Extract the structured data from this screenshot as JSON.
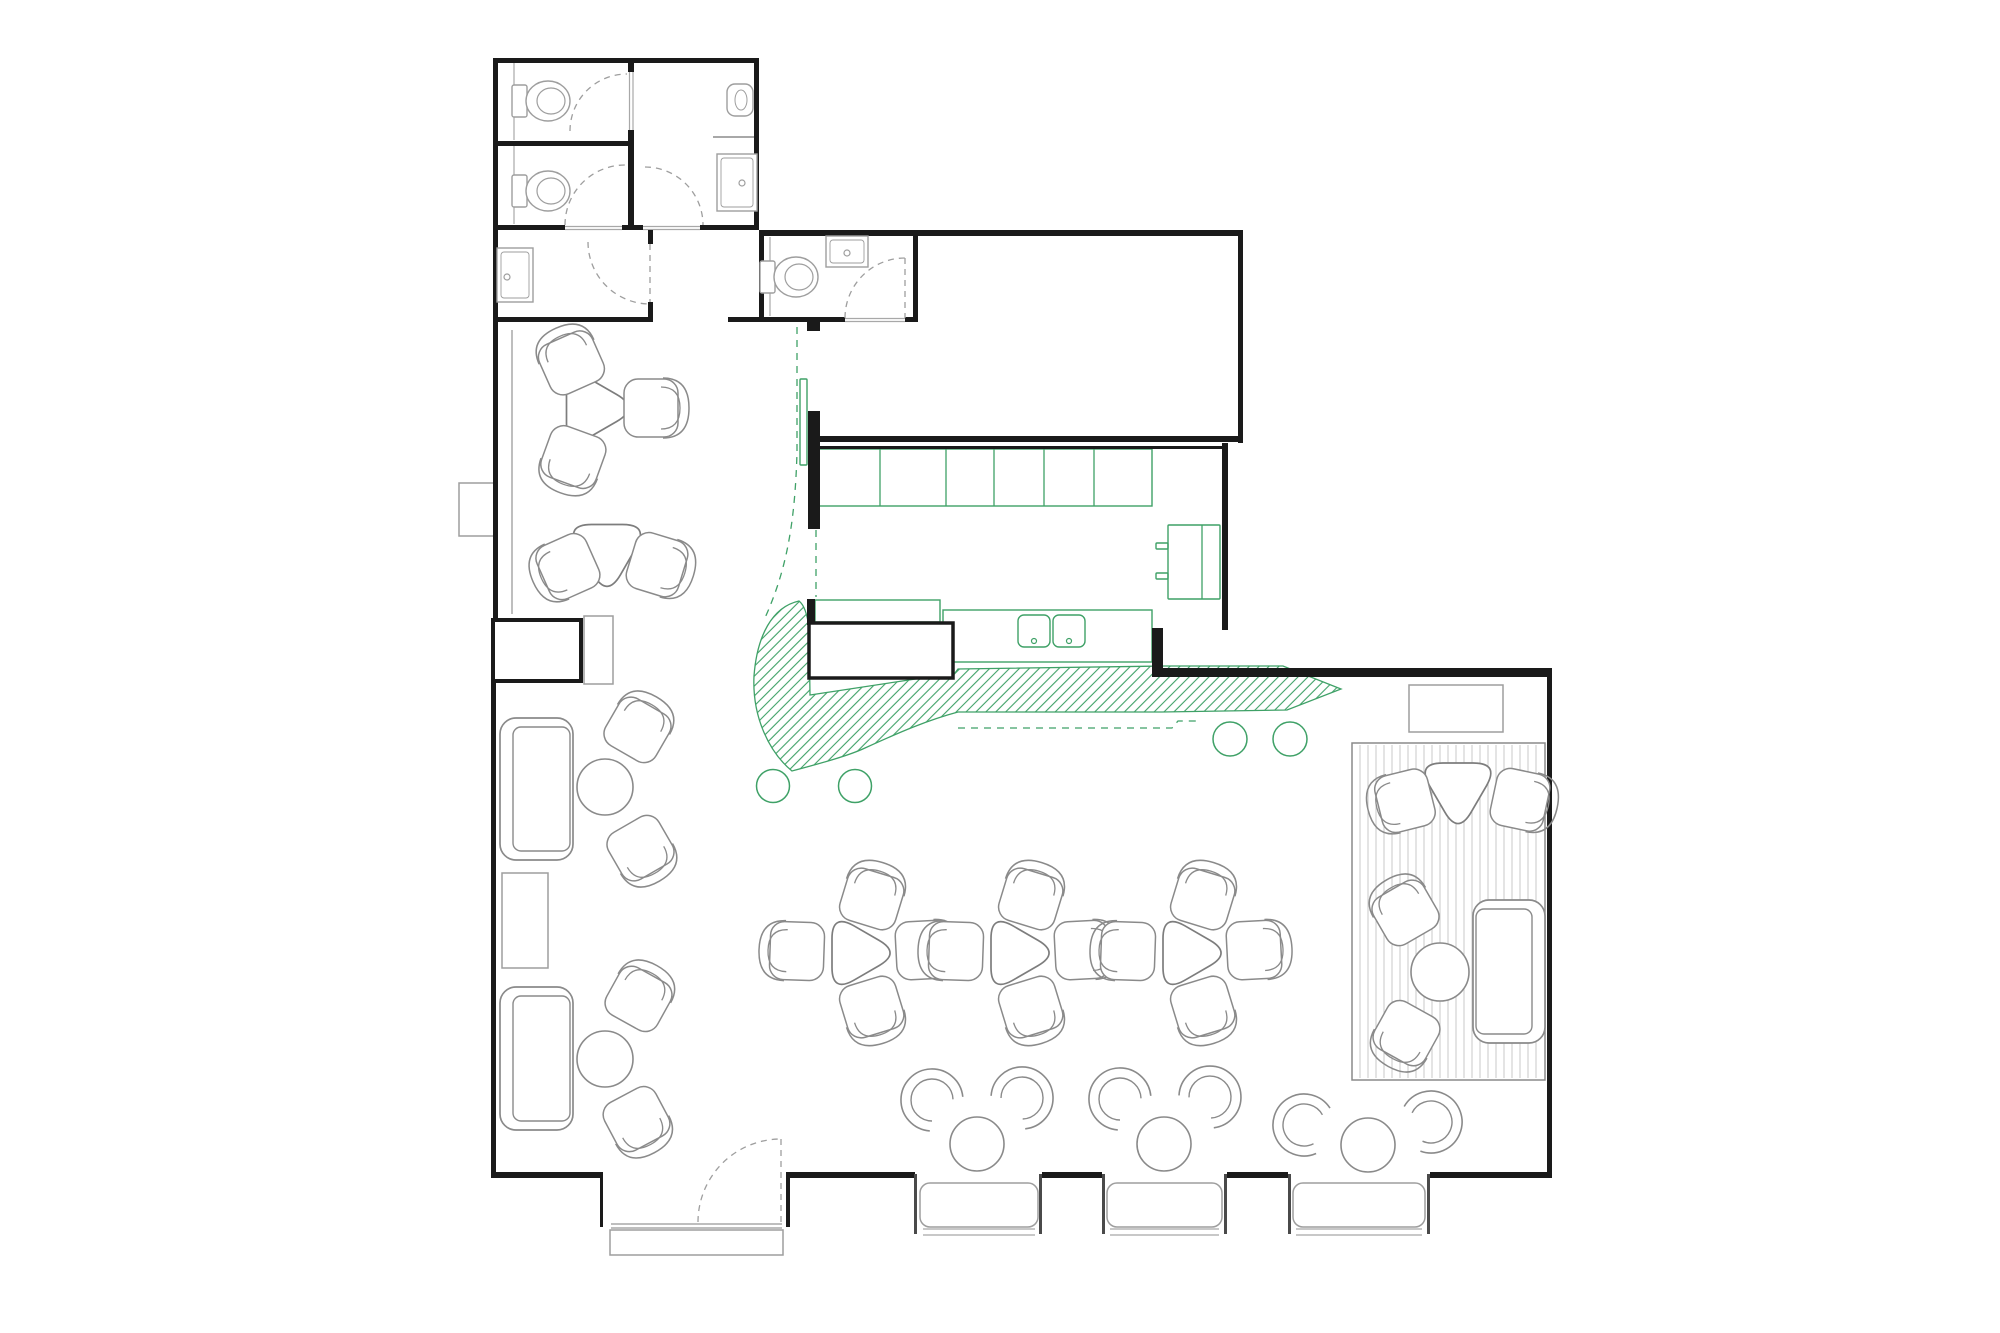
{
  "meta": {
    "title": "Restaurant floor plan with bar, kitchen, WC block, lounge and window seating"
  },
  "palette": {
    "bg": "#ffffff",
    "wall": "#1a1a1a",
    "jamb": "#4a4a4a",
    "furniture": "#8a8a8a",
    "fixture": "#9e9e9e",
    "grey_line": "#a8a8a8",
    "rug_stripe": "#c9c9c9",
    "dash_grey": "#9e9e9e",
    "green": "#3fa167"
  },
  "plan": {
    "walls": [
      [
        493,
        58,
        266,
        5
      ],
      [
        493,
        58,
        5,
        264
      ],
      [
        754,
        58,
        5,
        172
      ],
      [
        628,
        58,
        6,
        14
      ],
      [
        628,
        130,
        6,
        100
      ],
      [
        493,
        141,
        141,
        5
      ],
      [
        493,
        225,
        72,
        5
      ],
      [
        622,
        225,
        21,
        5
      ],
      [
        700,
        225,
        59,
        5
      ],
      [
        493,
        317,
        160,
        5
      ],
      [
        648,
        230,
        5,
        14
      ],
      [
        648,
        302,
        5,
        20
      ],
      [
        728,
        317,
        117,
        5
      ],
      [
        905,
        317,
        13,
        5
      ],
      [
        807,
        322,
        13,
        9
      ],
      [
        759,
        230,
        159,
        6
      ],
      [
        759,
        230,
        5,
        92
      ],
      [
        913,
        230,
        5,
        92
      ],
      [
        918,
        230,
        325,
        6
      ],
      [
        1238,
        230,
        5,
        213
      ],
      [
        812,
        436,
        431,
        6
      ],
      [
        812,
        446,
        416,
        3
      ],
      [
        808,
        411,
        12,
        118
      ],
      [
        1222,
        443,
        6,
        187
      ],
      [
        1152,
        628,
        11,
        49
      ],
      [
        1152,
        668,
        400,
        9
      ],
      [
        1547,
        668,
        5,
        510
      ],
      [
        493,
        322,
        5,
        300
      ],
      [
        491,
        681,
        5,
        497
      ],
      [
        493,
        1172,
        107,
        6
      ],
      [
        790,
        1172,
        125,
        6
      ],
      [
        1042,
        1172,
        60,
        6
      ],
      [
        1227,
        1172,
        61,
        6
      ],
      [
        1430,
        1172,
        122,
        6
      ],
      [
        600,
        1172,
        3,
        55
      ],
      [
        786,
        1172,
        4,
        55
      ],
      [
        807,
        599,
        8,
        26
      ]
    ],
    "jambs": [
      [
        914,
        1174,
        3,
        60
      ],
      [
        1039,
        1174,
        3,
        60
      ],
      [
        1102,
        1174,
        3,
        60
      ],
      [
        1224,
        1174,
        3,
        60
      ],
      [
        1288,
        1174,
        3,
        60
      ],
      [
        1427,
        1174,
        3,
        60
      ]
    ],
    "piers": [
      {
        "x": 493,
        "y": 620,
        "w": 88,
        "h": 61,
        "sw": 4,
        "name": "wall-pier"
      },
      {
        "x": 809,
        "y": 623,
        "w": 144,
        "h": 55,
        "sw": 3.5,
        "name": "bar-counter-block"
      }
    ],
    "grey_rects": [
      {
        "x": 584,
        "y": 616,
        "w": 29,
        "h": 68,
        "name": "service-console"
      },
      {
        "x": 502,
        "y": 873,
        "w": 46,
        "h": 95,
        "name": "low-table"
      },
      {
        "x": 1409,
        "y": 685,
        "w": 94,
        "h": 47,
        "name": "sideboard"
      },
      {
        "x": 459,
        "y": 483,
        "w": 38,
        "h": 53,
        "name": "wall-pier-west"
      },
      {
        "x": 610,
        "y": 1230,
        "w": 173,
        "h": 25,
        "name": "entry-mat"
      }
    ],
    "grey_lines": [
      [
        512,
        330,
        512,
        614,
        1.5
      ],
      [
        713,
        137,
        754,
        137,
        2
      ],
      [
        565,
        226.5,
        622,
        226.5,
        1.2
      ],
      [
        565,
        229.5,
        622,
        229.5,
        1.2
      ],
      [
        643,
        226.5,
        700,
        226.5,
        1.2
      ],
      [
        643,
        229.5,
        700,
        229.5,
        1.2
      ],
      [
        629.5,
        70,
        629.5,
        132,
        1.2
      ],
      [
        633,
        70,
        633,
        132,
        1.2
      ],
      [
        845,
        318.5,
        905,
        318.5,
        1.2
      ],
      [
        845,
        321.5,
        905,
        321.5,
        1.2
      ],
      [
        611,
        1224,
        782,
        1224,
        1.5
      ],
      [
        611,
        1228,
        782,
        1228,
        1.5
      ],
      [
        514,
        63,
        514,
        140,
        1.2
      ],
      [
        514,
        146,
        514,
        224,
        1.2
      ],
      [
        770,
        237,
        770,
        316,
        1.2
      ],
      [
        923,
        1229,
        1035,
        1229,
        1.2
      ],
      [
        923,
        1235,
        1035,
        1235,
        1.2
      ],
      [
        1110,
        1229,
        1219,
        1229,
        1.2
      ],
      [
        1110,
        1235,
        1219,
        1235,
        1.2
      ],
      [
        1296,
        1229,
        1422,
        1229,
        1.2
      ],
      [
        1296,
        1235,
        1422,
        1235,
        1.2
      ]
    ],
    "door_arcs": [
      "M570,131 A57,57 0 0 1 627,74",
      "M565,225 A60,60 0 0 1 625,165",
      "M645,167 A58,58 0 0 1 703,225",
      "M588,242 A62,62 0 0 0 650,304",
      "M845,318 A60,60 0 0 1 905,258",
      "M698,1222 A83,83 0 0 1 781,1139"
    ],
    "door_leaves": [
      [
        905,
        258,
        905,
        318
      ],
      [
        781,
        1139,
        781,
        1222
      ],
      [
        650,
        244,
        650,
        302
      ]
    ],
    "toilets": [
      {
        "cx": 545,
        "cy": 101
      },
      {
        "cx": 545,
        "cy": 191
      },
      {
        "cx": 793,
        "cy": 277
      }
    ],
    "sinks": [
      {
        "x": 717,
        "y": 154,
        "w": 40,
        "h": 57,
        "dx": 742,
        "dy": 183
      },
      {
        "x": 497,
        "y": 248,
        "w": 36,
        "h": 54,
        "dx": 507,
        "dy": 277
      },
      {
        "x": 826,
        "y": 236,
        "w": 42,
        "h": 31,
        "dx": 847,
        "dy": 253
      }
    ],
    "urinal": {
      "x": 727,
      "y": 84,
      "w": 26,
      "h": 32
    },
    "green": {
      "rects": [
        {
          "x": 800,
          "y": 379,
          "w": 7,
          "h": 86,
          "rx": 1,
          "name": "pass-shelf"
        },
        {
          "x": 818,
          "y": 449,
          "w": 334,
          "h": 57,
          "rx": 0,
          "name": "kitchen-back-counter"
        },
        {
          "x": 1168,
          "y": 525,
          "w": 52,
          "h": 74,
          "rx": 1,
          "name": "fridge"
        },
        {
          "x": 943,
          "y": 610,
          "w": 209,
          "h": 52,
          "rx": 0,
          "name": "kitchen-sink-counter"
        },
        {
          "x": 815,
          "y": 600,
          "w": 125,
          "h": 22,
          "rx": 0,
          "name": "bar-top"
        },
        {
          "x": 1018,
          "y": 615,
          "w": 32,
          "h": 32,
          "rx": 6,
          "name": "sink-basin"
        },
        {
          "x": 1053,
          "y": 615,
          "w": 32,
          "h": 32,
          "rx": 6,
          "name": "sink-basin"
        },
        {
          "x": 1156,
          "y": 543,
          "w": 12,
          "h": 6,
          "rx": 1,
          "name": "fridge-handle"
        },
        {
          "x": 1156,
          "y": 573,
          "w": 12,
          "h": 6,
          "rx": 1,
          "name": "fridge-handle"
        }
      ],
      "lines": [
        [
          880,
          449,
          880,
          506
        ],
        [
          946,
          449,
          946,
          506
        ],
        [
          994,
          449,
          994,
          506
        ],
        [
          1044,
          449,
          1044,
          506
        ],
        [
          1094,
          449,
          1094,
          506
        ],
        [
          1202,
          525,
          1202,
          599
        ]
      ],
      "dots": [
        [
          1034,
          641
        ],
        [
          1069,
          641
        ]
      ],
      "circles": [
        [
          773,
          786,
          16.5
        ],
        [
          855,
          786,
          16.5
        ],
        [
          1230,
          739,
          17
        ],
        [
          1290,
          739,
          17
        ]
      ],
      "dashed": [
        "M797,327 L797,452 C795,525 786,572 764,620",
        "M816,452 L816,597",
        "M958,728 L1172,728 L1178,721 L1200,721"
      ],
      "hatch": "M799,601 C772,607 757,636 754,676 C752,718 770,753 792,771 C818,764 848,756 865,748 C900,732 928,720 958,712 L1162,712 L1287,710 L1341,689 L1283,666 L1165,666 L958,669 L955,673 L810,695 L809,628 C807,612 803,604 799,601 Z"
    },
    "tri_tables": [
      {
        "cx": 591,
        "cy": 408,
        "R": 49,
        "rot": 90
      },
      {
        "cx": 607,
        "cy": 549,
        "R": 49,
        "rot": 180
      },
      {
        "cx": 855,
        "cy": 953,
        "R": 46,
        "rot": 90
      },
      {
        "cx": 1014,
        "cy": 953,
        "R": 46,
        "rot": 90
      },
      {
        "cx": 1186,
        "cy": 953,
        "R": 46,
        "rot": 90
      },
      {
        "cx": 1458,
        "cy": 787,
        "R": 48,
        "rot": 180
      }
    ],
    "chairs": [
      {
        "cx": 571,
        "cy": 362,
        "f": 66
      },
      {
        "cx": 573,
        "cy": 458,
        "f": -70
      },
      {
        "cx": 652,
        "cy": 408,
        "f": 180
      },
      {
        "cx": 567,
        "cy": 567,
        "f": -24
      },
      {
        "cx": 658,
        "cy": 565,
        "f": 197
      },
      {
        "cx": 872,
        "cy": 898,
        "f": 107
      },
      {
        "cx": 872,
        "cy": 1008,
        "f": -107
      },
      {
        "cx": 796,
        "cy": 951,
        "f": 2
      },
      {
        "cx": 924,
        "cy": 950,
        "f": 177
      },
      {
        "cx": 1031,
        "cy": 898,
        "f": 107
      },
      {
        "cx": 1031,
        "cy": 1008,
        "f": -107
      },
      {
        "cx": 955,
        "cy": 951,
        "f": 2
      },
      {
        "cx": 1083,
        "cy": 950,
        "f": 177
      },
      {
        "cx": 1203,
        "cy": 898,
        "f": 107
      },
      {
        "cx": 1203,
        "cy": 1008,
        "f": -107
      },
      {
        "cx": 1127,
        "cy": 951,
        "f": 2
      },
      {
        "cx": 1255,
        "cy": 950,
        "f": 177
      },
      {
        "cx": 1404,
        "cy": 801,
        "f": -14
      },
      {
        "cx": 1521,
        "cy": 800,
        "f": 192
      },
      {
        "cx": 638,
        "cy": 729,
        "f": 120
      },
      {
        "cx": 641,
        "cy": 849,
        "f": 240
      },
      {
        "cx": 639,
        "cy": 998,
        "f": 119
      },
      {
        "cx": 637,
        "cy": 1120,
        "f": 242
      },
      {
        "cx": 1405,
        "cy": 912,
        "f": 60
      },
      {
        "cx": 1406,
        "cy": 1034,
        "f": -61
      }
    ],
    "tub_chairs": [
      {
        "cx": 932,
        "cy": 1100,
        "f": 44
      },
      {
        "cx": 1022,
        "cy": 1098,
        "f": 134
      },
      {
        "cx": 1120,
        "cy": 1099,
        "f": 44
      },
      {
        "cx": 1210,
        "cy": 1097,
        "f": 133
      },
      {
        "cx": 1304,
        "cy": 1125,
        "f": 17
      },
      {
        "cx": 1431,
        "cy": 1122,
        "f": 160
      }
    ],
    "round_tables": [
      [
        605,
        787,
        28
      ],
      [
        605,
        1059,
        28
      ],
      [
        977,
        1144,
        27
      ],
      [
        1164,
        1144,
        27
      ],
      [
        1368,
        1145,
        27
      ],
      [
        1440,
        972,
        29
      ]
    ],
    "sofas": [
      {
        "x": 500,
        "y": 718,
        "w": 73,
        "h": 142,
        "back": "left"
      },
      {
        "x": 500,
        "y": 987,
        "w": 73,
        "h": 143,
        "back": "left"
      },
      {
        "x": 1473,
        "y": 900,
        "w": 72,
        "h": 143,
        "back": "right"
      }
    ],
    "rug": {
      "x": 1352,
      "y": 743,
      "w": 193,
      "h": 337,
      "gap": 8
    },
    "benches": [
      [
        920,
        1183,
        118,
        44
      ],
      [
        1107,
        1183,
        115,
        44
      ],
      [
        1293,
        1183,
        132,
        44
      ]
    ]
  }
}
